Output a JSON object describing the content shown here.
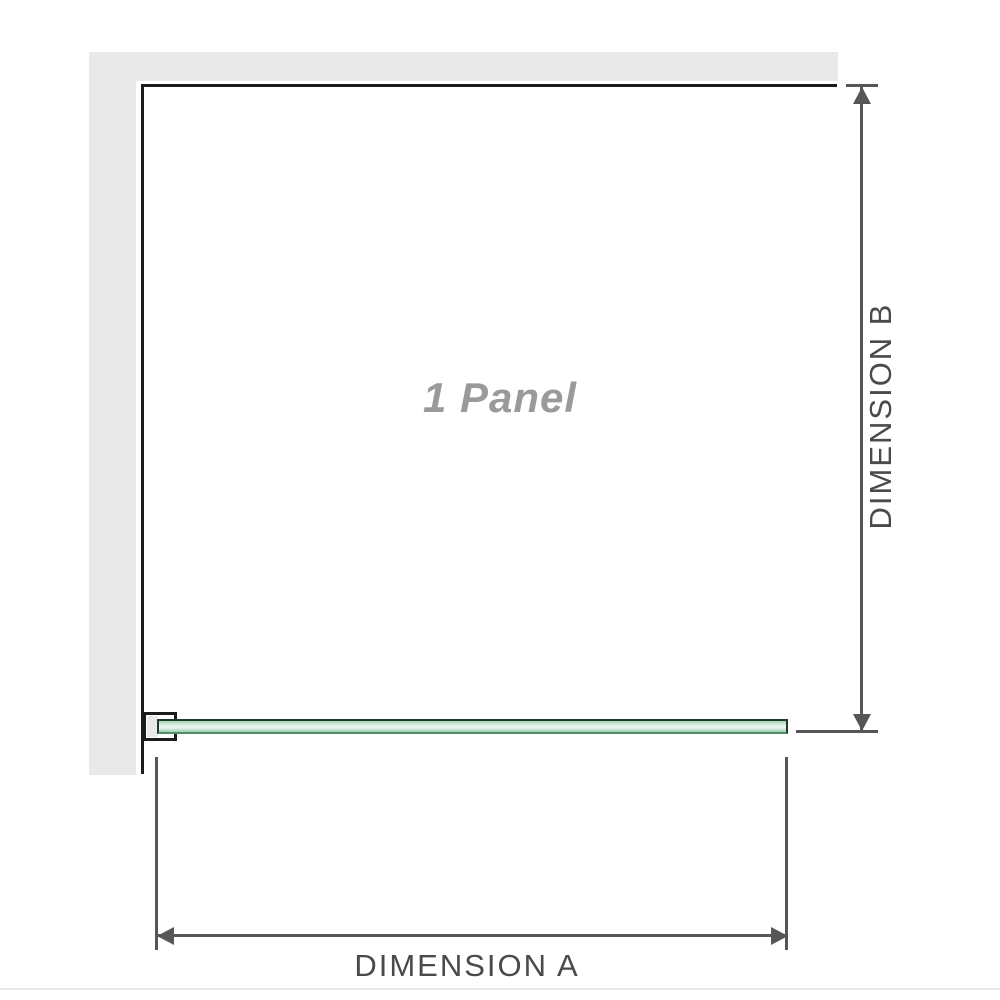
{
  "diagram": {
    "panel_label": "1 Panel",
    "dimension_a_label": "DIMENSION A",
    "dimension_b_label": "DIMENSION B"
  },
  "icons": {
    "dimension_b_top": "arrow-up-icon",
    "dimension_b_bottom": "arrow-down-icon",
    "dimension_a_left": "arrow-left-icon",
    "dimension_a_right": "arrow-right-icon"
  },
  "colors": {
    "wall_gray": "#e9e9e9",
    "outline_black": "#1b1b1b",
    "dimension_gray": "#565656",
    "label_gray": "#4a4a4a",
    "panel_text_gray": "#9a9a9a",
    "glass_top": "#9ed3af",
    "glass_light": "#e9f7ee",
    "glass_bottom": "#9ccfae",
    "glass_border_dark": "#223a2b",
    "glass_border_bottom": "#578a68",
    "hairline": "#e7e7e7"
  }
}
